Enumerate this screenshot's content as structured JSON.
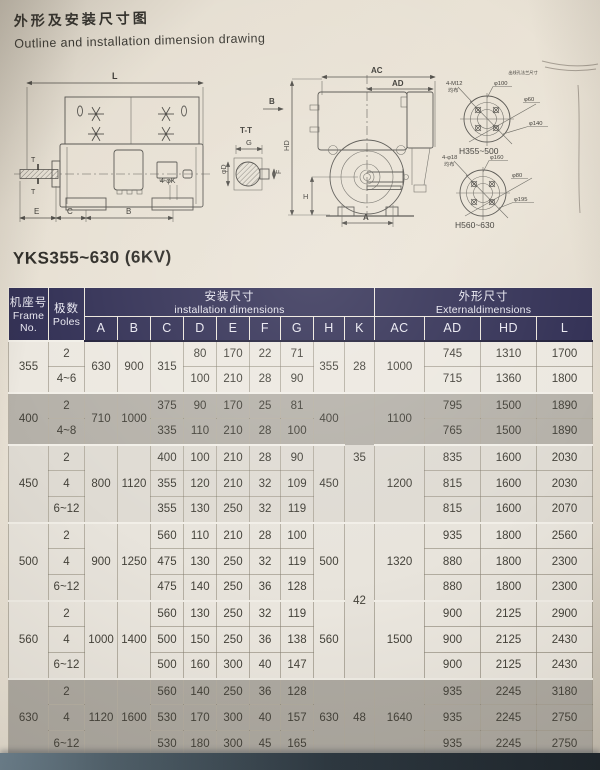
{
  "page": {
    "title_zh": "外形及安装尺寸图",
    "title_en": "Outline and installation dimension drawing",
    "model": "YKS355~630 (6KV)"
  },
  "drawing": {
    "side": {
      "dim_l": "L",
      "dim_e": "E",
      "dim_c": "C",
      "dim_b": "B",
      "holes": "4-φK",
      "t_upper": "T",
      "t_lower": "T"
    },
    "section": {
      "title": "T-T",
      "dim_g": "G",
      "dim_f": "F",
      "dim_d": "φD"
    },
    "view_b": "B",
    "end": {
      "dim_ac": "AC",
      "dim_ad": "AD",
      "dim_hd": "HD",
      "dim_h": "H",
      "dim_a": "A"
    },
    "flange1": {
      "note": "出线孔法兰尺寸",
      "bolts": "4-M12",
      "evenly": "均布",
      "d1": "φ100",
      "d2": "φ60",
      "d3": "φ140",
      "caption": "H355~500"
    },
    "flange2": {
      "bolts": "4-φ18",
      "evenly": "均布",
      "d1": "φ160",
      "d2": "φ80",
      "d3": "φ195",
      "caption": "H560~630"
    }
  },
  "table": {
    "header": {
      "frame_zh": "机座号",
      "frame_en": "Frame",
      "frame_no": "No.",
      "poles_zh": "极数",
      "poles_en": "Poles",
      "install_zh": "安装尺寸",
      "install_en": "installation dimensions",
      "external_zh": "外形尺寸",
      "external_en": "Externaldimensions",
      "cols": [
        "A",
        "B",
        "C",
        "D",
        "E",
        "F",
        "G",
        "H",
        "K",
        "AC",
        "AD",
        "HD",
        "L"
      ]
    },
    "g355": {
      "frame": "355",
      "A": "630",
      "B": "900",
      "C": "315",
      "H": "355",
      "K": "28",
      "AC": "1000",
      "r1": {
        "poles": "2",
        "D": "80",
        "E": "170",
        "F": "22",
        "G": "71",
        "AD": "745",
        "HD": "1310",
        "L": "1700"
      },
      "r2": {
        "poles": "4~6",
        "D": "100",
        "E": "210",
        "F": "28",
        "G": "90",
        "AD": "715",
        "HD": "1360",
        "L": "1800"
      }
    },
    "g400": {
      "frame": "400",
      "A": "710",
      "B": "1000",
      "H": "400",
      "K": "35",
      "AC": "1100",
      "r1": {
        "poles": "2",
        "C": "375",
        "D": "90",
        "E": "170",
        "F": "25",
        "G": "81",
        "AD": "795",
        "HD": "1500",
        "L": "1890"
      },
      "r2": {
        "poles": "4~8",
        "C": "335",
        "D": "110",
        "E": "210",
        "F": "28",
        "G": "100",
        "AD": "765",
        "HD": "1500",
        "L": "1890"
      }
    },
    "g450": {
      "frame": "450",
      "A": "800",
      "B": "1120",
      "H": "450",
      "AC": "1200",
      "r1": {
        "poles": "2",
        "C": "400",
        "D": "100",
        "E": "210",
        "F": "28",
        "G": "90",
        "AD": "835",
        "HD": "1600",
        "L": "2030"
      },
      "r2": {
        "poles": "4",
        "C": "355",
        "D": "120",
        "E": "210",
        "F": "32",
        "G": "109",
        "AD": "815",
        "HD": "1600",
        "L": "2030"
      },
      "r3": {
        "poles": "6~12",
        "C": "355",
        "D": "130",
        "E": "250",
        "F": "32",
        "G": "119",
        "AD": "815",
        "HD": "1600",
        "L": "2070"
      }
    },
    "g500": {
      "frame": "500",
      "A": "900",
      "B": "1250",
      "H": "500",
      "K": "42",
      "AC": "1320",
      "r1": {
        "poles": "2",
        "C": "560",
        "D": "110",
        "E": "210",
        "F": "28",
        "G": "100",
        "AD": "935",
        "HD": "1800",
        "L": "2560"
      },
      "r2": {
        "poles": "4",
        "C": "475",
        "D": "130",
        "E": "250",
        "F": "32",
        "G": "119",
        "AD": "880",
        "HD": "1800",
        "L": "2300"
      },
      "r3": {
        "poles": "6~12",
        "C": "475",
        "D": "140",
        "E": "250",
        "F": "36",
        "G": "128",
        "AD": "880",
        "HD": "1800",
        "L": "2300"
      }
    },
    "g560": {
      "frame": "560",
      "A": "1000",
      "B": "1400",
      "H": "560",
      "AC": "1500",
      "r1": {
        "poles": "2",
        "C": "560",
        "D": "130",
        "E": "250",
        "F": "32",
        "G": "119",
        "AD": "900",
        "HD": "2125",
        "L": "2900"
      },
      "r2": {
        "poles": "4",
        "C": "500",
        "D": "150",
        "E": "250",
        "F": "36",
        "G": "138",
        "AD": "900",
        "HD": "2125",
        "L": "2430"
      },
      "r3": {
        "poles": "6~12",
        "C": "500",
        "D": "160",
        "E": "300",
        "F": "40",
        "G": "147",
        "AD": "900",
        "HD": "2125",
        "L": "2430"
      }
    },
    "g630": {
      "frame": "630",
      "A": "1120",
      "B": "1600",
      "H": "630",
      "K": "48",
      "AC": "1640",
      "r1": {
        "poles": "2",
        "C": "560",
        "D": "140",
        "E": "250",
        "F": "36",
        "G": "128",
        "AD": "935",
        "HD": "2245",
        "L": "3180"
      },
      "r2": {
        "poles": "4",
        "C": "530",
        "D": "170",
        "E": "300",
        "F": "40",
        "G": "157",
        "AD": "935",
        "HD": "2245",
        "L": "2750"
      },
      "r3": {
        "poles": "6~12",
        "C": "530",
        "D": "180",
        "E": "300",
        "F": "45",
        "G": "165",
        "AD": "935",
        "HD": "2245",
        "L": "2750"
      }
    }
  },
  "colors": {
    "header_bg": "#312f54",
    "band_light": "#ece8e0",
    "band_gray": "#b5b1a9",
    "paper": "#e7e0d3",
    "photo_edge": "#19222a"
  }
}
